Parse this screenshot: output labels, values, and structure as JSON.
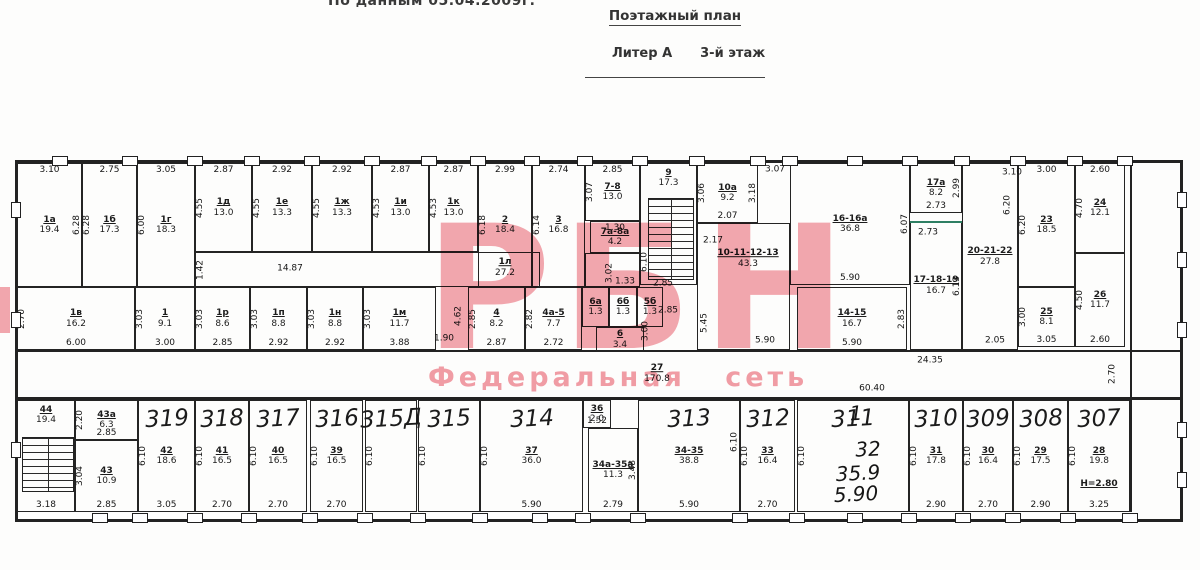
{
  "header": {
    "note": "По данным 05.04.2009г.",
    "title": "Поэтажный план",
    "subtitle_left": "Литер А",
    "subtitle_right": "3-й этаж"
  },
  "watermark": {
    "logo": "РБН",
    "tagline": "Федеральная сеть",
    "color": "#ef8590"
  },
  "colors": {
    "line_dark": "#222222",
    "marker_green": "#2e7f63"
  },
  "plan": {
    "marker_line": {
      "x": 910,
      "y": 221,
      "w": 52,
      "h": 2
    },
    "rooms": [
      {
        "x": 17,
        "y": 163,
        "w": 65,
        "h": 124,
        "label": "1а",
        "area": "19.4",
        "t": "3.10",
        "r": "6.28"
      },
      {
        "x": 82,
        "y": 163,
        "w": 55,
        "h": 124,
        "label": "1б",
        "area": "17.3",
        "t": "2.75",
        "l": "6.28"
      },
      {
        "x": 137,
        "y": 163,
        "w": 58,
        "h": 124,
        "label": "1г",
        "area": "18.3",
        "t": "3.05",
        "l": "6.00"
      },
      {
        "x": 195,
        "y": 163,
        "w": 57,
        "h": 89,
        "label": "1д",
        "area": "13.0",
        "t": "2.87",
        "l": "4.55"
      },
      {
        "x": 252,
        "y": 163,
        "w": 60,
        "h": 89,
        "label": "1е",
        "area": "13.3",
        "t": "2.92",
        "l": "4.55"
      },
      {
        "x": 312,
        "y": 163,
        "w": 60,
        "h": 89,
        "label": "1ж",
        "area": "13.3",
        "t": "2.92",
        "l": "4.55"
      },
      {
        "x": 372,
        "y": 163,
        "w": 57,
        "h": 89,
        "label": "1и",
        "area": "13.0",
        "t": "2.87",
        "l": "4.53"
      },
      {
        "x": 429,
        "y": 163,
        "w": 49,
        "h": 89,
        "label": "1к",
        "area": "13.0",
        "t": "2.87",
        "l": "4.53"
      },
      {
        "x": 195,
        "y": 252,
        "w": 345,
        "h": 35
      },
      {
        "x": 478,
        "y": 163,
        "w": 54,
        "h": 124,
        "label": "2",
        "area": "18.4",
        "t": "2.99",
        "l": "6.18"
      },
      {
        "x": 532,
        "y": 163,
        "w": 53,
        "h": 124,
        "label": "3",
        "area": "16.8",
        "t": "2.74",
        "l": "6.14"
      },
      {
        "x": 585,
        "y": 163,
        "w": 55,
        "h": 58,
        "label": "7-8",
        "area": "13.0",
        "t": "2.85",
        "l": "3.07"
      },
      {
        "x": 590,
        "y": 221,
        "w": 50,
        "h": 32,
        "label": "7а-8а",
        "area": "4.2",
        "t": "1.30"
      },
      {
        "x": 585,
        "y": 253,
        "w": 55,
        "h": 34
      },
      {
        "x": 640,
        "y": 163,
        "w": 57,
        "h": 122,
        "label": "9",
        "area": "17.3",
        "lp": "t"
      },
      {
        "x": 697,
        "y": 163,
        "w": 61,
        "h": 60,
        "label": "10а",
        "area": "9.2",
        "l": "3.06",
        "r": "3.18",
        "b": "2.07"
      },
      {
        "x": 697,
        "y": 223,
        "w": 93,
        "h": 127
      },
      {
        "x": 790,
        "y": 163,
        "w": 120,
        "h": 122,
        "label": "16-16а",
        "area": "36.8",
        "r": "6.07",
        "b": "5.90"
      },
      {
        "x": 910,
        "y": 163,
        "w": 52,
        "h": 50,
        "label": "17а",
        "area": "8.2",
        "r": "2.99",
        "b": "2.73"
      },
      {
        "x": 910,
        "y": 221,
        "w": 52,
        "h": 129,
        "label": "17-18-19",
        "area": "16.7",
        "r": "6.13"
      },
      {
        "x": 962,
        "y": 163,
        "w": 56,
        "h": 187,
        "label": "20-21-22",
        "area": "27.8"
      },
      {
        "x": 1018,
        "y": 163,
        "w": 57,
        "h": 124,
        "label": "23",
        "area": "18.5",
        "t": "3.00",
        "l": "6.20"
      },
      {
        "x": 1075,
        "y": 163,
        "w": 50,
        "h": 90,
        "label": "24",
        "area": "12.1",
        "t": "2.60",
        "l": "4.70"
      },
      {
        "x": 1075,
        "y": 253,
        "w": 50,
        "h": 94,
        "label": "26",
        "area": "11.7",
        "l": "4.50",
        "b": "2.60"
      },
      {
        "x": 1018,
        "y": 287,
        "w": 57,
        "h": 60,
        "label": "25",
        "area": "8.1",
        "l": "3.00",
        "b": "3.05"
      },
      {
        "x": 17,
        "y": 287,
        "w": 118,
        "h": 63,
        "label": "1в",
        "area": "16.2",
        "l": "2.70",
        "b": "6.00"
      },
      {
        "x": 135,
        "y": 287,
        "w": 60,
        "h": 63,
        "label": "1",
        "area": "9.1",
        "l": "3.03",
        "b": "3.00"
      },
      {
        "x": 195,
        "y": 287,
        "w": 55,
        "h": 63,
        "label": "1р",
        "area": "8.6",
        "l": "3.03",
        "b": "2.85"
      },
      {
        "x": 250,
        "y": 287,
        "w": 57,
        "h": 63,
        "label": "1п",
        "area": "8.8",
        "l": "3.03",
        "b": "2.92"
      },
      {
        "x": 307,
        "y": 287,
        "w": 56,
        "h": 63,
        "label": "1н",
        "area": "8.8",
        "l": "3.03",
        "b": "2.92"
      },
      {
        "x": 363,
        "y": 287,
        "w": 73,
        "h": 63,
        "label": "1м",
        "area": "11.7",
        "l": "3.03",
        "b": "3.88"
      },
      {
        "x": 468,
        "y": 287,
        "w": 57,
        "h": 63,
        "label": "4",
        "area": "8.2",
        "l": "2.85",
        "b": "2.87"
      },
      {
        "x": 525,
        "y": 287,
        "w": 57,
        "h": 63,
        "label": "4а-5",
        "area": "7.7",
        "l": "2.82",
        "b": "2.72"
      },
      {
        "x": 582,
        "y": 287,
        "w": 27,
        "h": 40,
        "label": "6а",
        "area": "1.3"
      },
      {
        "x": 609,
        "y": 287,
        "w": 28,
        "h": 40,
        "label": "6б",
        "area": "1.3"
      },
      {
        "x": 637,
        "y": 287,
        "w": 26,
        "h": 40,
        "label": "5б",
        "area": "1.3"
      },
      {
        "x": 596,
        "y": 327,
        "w": 48,
        "h": 25,
        "label": "6",
        "area": "3.4"
      },
      {
        "x": 797,
        "y": 287,
        "w": 110,
        "h": 63,
        "label": "14-15",
        "area": "16.7",
        "r": "2.83",
        "b": "5.90"
      },
      {
        "x": 17,
        "y": 400,
        "w": 58,
        "h": 112,
        "label": "44",
        "area": "19.4",
        "b": "3.18",
        "lp": "t"
      },
      {
        "x": 75,
        "y": 400,
        "w": 63,
        "h": 40,
        "label": "43а",
        "area": "6.3",
        "l": "2.20",
        "b": "2.85"
      },
      {
        "x": 75,
        "y": 440,
        "w": 63,
        "h": 72,
        "label": "43",
        "area": "10.9",
        "l": "3.04",
        "b": "2.85"
      },
      {
        "x": 138,
        "y": 400,
        "w": 57,
        "h": 112,
        "hand": "319",
        "label": "42",
        "area": "18.6",
        "l": "6.10",
        "b": "3.05"
      },
      {
        "x": 195,
        "y": 400,
        "w": 54,
        "h": 112,
        "hand": "318",
        "label": "41",
        "area": "16.5",
        "l": "6.10",
        "b": "2.70"
      },
      {
        "x": 249,
        "y": 400,
        "w": 58,
        "h": 112,
        "hand": "317",
        "label": "40",
        "area": "16.5",
        "l": "6.10",
        "b": "2.70"
      },
      {
        "x": 310,
        "y": 400,
        "w": 53,
        "h": 112,
        "hand": "316",
        "label": "39",
        "area": "16.5",
        "l": "6.10",
        "b": "2.70"
      },
      {
        "x": 365,
        "y": 400,
        "w": 52,
        "h": 112,
        "hand": "315Д",
        "l": "6.10"
      },
      {
        "x": 418,
        "y": 400,
        "w": 62,
        "h": 112,
        "hand": "315",
        "l": "6.10"
      },
      {
        "x": 480,
        "y": 400,
        "w": 103,
        "h": 112,
        "hand": "314",
        "label": "37",
        "area": "36.0",
        "l": "6.10",
        "b": "5.90"
      },
      {
        "x": 583,
        "y": 400,
        "w": 28,
        "h": 28,
        "label": "36",
        "area": "2.0",
        "b": "1.52"
      },
      {
        "x": 588,
        "y": 428,
        "w": 50,
        "h": 84,
        "label": "34а-35а",
        "area": "11.3",
        "r": "3.48",
        "b": "2.79"
      },
      {
        "x": 638,
        "y": 400,
        "w": 102,
        "h": 112,
        "hand": "313",
        "label": "34-35",
        "area": "38.8",
        "b": "5.90"
      },
      {
        "x": 740,
        "y": 400,
        "w": 55,
        "h": 112,
        "hand": "312",
        "label": "33",
        "area": "16.4",
        "l": "6.10",
        "b": "2.70"
      },
      {
        "x": 797,
        "y": 400,
        "w": 112,
        "h": 112,
        "hand": "311",
        "l": "6.10"
      },
      {
        "x": 909,
        "y": 400,
        "w": 54,
        "h": 112,
        "hand": "310",
        "label": "31",
        "area": "17.8",
        "l": "6.10",
        "b": "2.90"
      },
      {
        "x": 963,
        "y": 400,
        "w": 50,
        "h": 112,
        "hand": "309",
        "label": "30",
        "area": "16.4",
        "l": "6.10",
        "b": "2.70"
      },
      {
        "x": 1013,
        "y": 400,
        "w": 55,
        "h": 112,
        "hand": "308",
        "label": "29",
        "area": "17.5",
        "l": "6.10",
        "b": "2.90"
      },
      {
        "x": 1068,
        "y": 400,
        "w": 62,
        "h": 112,
        "hand": "307",
        "label": "28",
        "area": "19.8",
        "l": "6.10",
        "b": "3.25",
        "extra": "Н=2.80"
      }
    ],
    "texts": [
      {
        "x": 290,
        "y": 269,
        "t": "14.87"
      },
      {
        "x": 201,
        "y": 270,
        "t": "1.42",
        "r": 1
      },
      {
        "x": 505,
        "y": 268,
        "t": "1л",
        "ul": 1,
        "sub": "27.2"
      },
      {
        "x": 610,
        "y": 273,
        "t": "3.02",
        "r": 1
      },
      {
        "x": 625,
        "y": 282,
        "t": "1.33"
      },
      {
        "x": 645,
        "y": 262,
        "t": "6.10",
        "r": 1
      },
      {
        "x": 775,
        "y": 170,
        "t": "3.07"
      },
      {
        "x": 713,
        "y": 241,
        "t": "2.17"
      },
      {
        "x": 748,
        "y": 259,
        "t": "10-11-12-13",
        "ul": 1,
        "sub": "43.3"
      },
      {
        "x": 663,
        "y": 284,
        "t": "2.85"
      },
      {
        "x": 646,
        "y": 331,
        "t": "3.00",
        "r": 1
      },
      {
        "x": 668,
        "y": 311,
        "t": "2.85"
      },
      {
        "x": 705,
        "y": 323,
        "t": "5.45",
        "r": 1
      },
      {
        "x": 765,
        "y": 341,
        "t": "5.90"
      },
      {
        "x": 444,
        "y": 339,
        "t": "1.90"
      },
      {
        "x": 459,
        "y": 316,
        "t": "4.62",
        "r": 1
      },
      {
        "x": 995,
        "y": 341,
        "t": "2.05"
      },
      {
        "x": 930,
        "y": 361,
        "t": "24.35"
      },
      {
        "x": 872,
        "y": 389,
        "t": "60.40"
      },
      {
        "x": 1113,
        "y": 374,
        "t": "2.70",
        "r": 1
      },
      {
        "x": 657,
        "y": 374,
        "t": "27",
        "ul": 1,
        "sub": "170.8"
      },
      {
        "x": 1012,
        "y": 173,
        "t": "3.10"
      },
      {
        "x": 1008,
        "y": 205,
        "t": "6.20",
        "r": 1
      },
      {
        "x": 928,
        "y": 233,
        "t": "2.73"
      },
      {
        "x": 735,
        "y": 442,
        "t": "6.10",
        "r": 1
      },
      {
        "x": 856,
        "y": 413,
        "t": "1",
        "hand": 1
      },
      {
        "x": 868,
        "y": 449,
        "t": "32",
        "hand": 1
      },
      {
        "x": 858,
        "y": 473,
        "t": "35.9",
        "hand": 1
      },
      {
        "x": 856,
        "y": 494,
        "t": "5.90",
        "hand": 1
      }
    ],
    "stairs": [
      {
        "x": 648,
        "y": 198,
        "w": 46,
        "h": 82
      },
      {
        "x": 22,
        "y": 437,
        "w": 52,
        "h": 55
      }
    ]
  }
}
